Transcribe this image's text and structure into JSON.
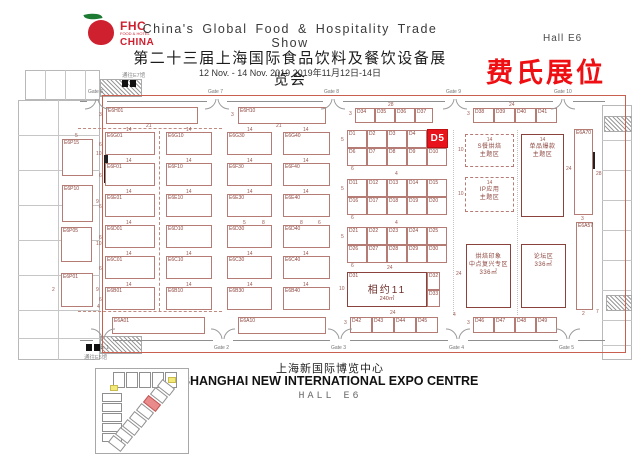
{
  "header": {
    "logo": {
      "fhc": "FHC",
      "sub": "FOOD & HOTEL",
      "china": "CHINA"
    },
    "title_en": "China's Global Food & Hospitality Trade Show",
    "hall": "Hall E6",
    "title_cn": "第二十三届上海国际食品饮料及餐饮设备展览会",
    "dates": "12 Nov. - 14 Nov. 2019   2019年11月12日-14日",
    "note": "费氏展位"
  },
  "footer": {
    "cn": "上海新国际博览中心",
    "en": "SHANGHAI NEW INTERNATIONAL EXPO CENTRE",
    "hall": "HALL E6"
  },
  "colors": {
    "booth_border": "#b57c75",
    "booth_label": "#8d463f",
    "highlight_bg": "#e8131b",
    "highlight_fg": "#ffffff",
    "hall_border": "#c9604f",
    "note_red": "#ef0e11",
    "logo_red": "#cf2030",
    "inset_highlight": "#e98b8b"
  },
  "plan": {
    "highlight_booth": {
      "id": "D5",
      "x": 427,
      "y": 129,
      "w": 21,
      "h": 19
    },
    "booths": [
      [
        "E6H01",
        106,
        107,
        92,
        17
      ],
      [
        "E6H10",
        238,
        107,
        88,
        17
      ],
      [
        "D34",
        355,
        108,
        20,
        15
      ],
      [
        "D35",
        375,
        108,
        20,
        15
      ],
      [
        "D36",
        395,
        108,
        20,
        15
      ],
      [
        "D37",
        415,
        108,
        18,
        15
      ],
      [
        "D38",
        473,
        108,
        21,
        15
      ],
      [
        "D39",
        494,
        108,
        21,
        15
      ],
      [
        "D40",
        515,
        108,
        21,
        15
      ],
      [
        "D41",
        536,
        108,
        21,
        15
      ],
      [
        "E6P15",
        62,
        139,
        31,
        37
      ],
      [
        "E6P10",
        62,
        185,
        31,
        37
      ],
      [
        "E6P05",
        61,
        227,
        31,
        35
      ],
      [
        "E6P01",
        61,
        273,
        32,
        34
      ],
      [
        "E6G01",
        105,
        132,
        50,
        23
      ],
      [
        "E6G10",
        166,
        132,
        46,
        23
      ],
      [
        "E6G30",
        227,
        132,
        45,
        23
      ],
      [
        "E6G40",
        283,
        132,
        47,
        23
      ],
      [
        "E6F01",
        105,
        163,
        50,
        23
      ],
      [
        "E6F10",
        166,
        163,
        46,
        23
      ],
      [
        "E6F30",
        227,
        163,
        45,
        23
      ],
      [
        "E6F40",
        283,
        163,
        47,
        23
      ],
      [
        "E6E01",
        105,
        194,
        50,
        23
      ],
      [
        "E6E10",
        166,
        194,
        46,
        23
      ],
      [
        "E6E30",
        227,
        194,
        45,
        23
      ],
      [
        "E6E40",
        283,
        194,
        47,
        23
      ],
      [
        "E6D01",
        105,
        225,
        50,
        23
      ],
      [
        "E6D10",
        166,
        225,
        46,
        23
      ],
      [
        "E6D30",
        227,
        225,
        45,
        23
      ],
      [
        "E6D40",
        283,
        225,
        47,
        23
      ],
      [
        "E6C01",
        105,
        256,
        50,
        23
      ],
      [
        "E6C10",
        166,
        256,
        46,
        23
      ],
      [
        "E6C30",
        227,
        256,
        45,
        23
      ],
      [
        "E6C40",
        283,
        256,
        47,
        23
      ],
      [
        "E6B01",
        105,
        287,
        50,
        23
      ],
      [
        "E6B10",
        166,
        287,
        46,
        23
      ],
      [
        "E6B30",
        227,
        287,
        45,
        23
      ],
      [
        "E6B40",
        283,
        287,
        47,
        23
      ],
      [
        "E6A01",
        112,
        317,
        93,
        17
      ],
      [
        "E6A10",
        238,
        317,
        88,
        17
      ],
      [
        "D42",
        350,
        317,
        22,
        16
      ],
      [
        "D43",
        372,
        317,
        22,
        16
      ],
      [
        "D44",
        394,
        317,
        22,
        16
      ],
      [
        "D45",
        416,
        317,
        22,
        16
      ],
      [
        "D46",
        473,
        317,
        21,
        16
      ],
      [
        "D47",
        494,
        317,
        21,
        16
      ],
      [
        "D48",
        515,
        317,
        21,
        16
      ],
      [
        "D49",
        536,
        317,
        21,
        16
      ],
      [
        "D1",
        347,
        130,
        20,
        18
      ],
      [
        "D2",
        367,
        130,
        20,
        18
      ],
      [
        "D3",
        387,
        130,
        20,
        18
      ],
      [
        "D4",
        407,
        130,
        20,
        18
      ],
      [
        "D6",
        347,
        148,
        20,
        18
      ],
      [
        "D7",
        367,
        148,
        20,
        18
      ],
      [
        "D8",
        387,
        148,
        20,
        18
      ],
      [
        "D9",
        407,
        148,
        20,
        18
      ],
      [
        "D10",
        427,
        148,
        20,
        18
      ],
      [
        "D11",
        347,
        179,
        20,
        18
      ],
      [
        "D12",
        367,
        179,
        20,
        18
      ],
      [
        "D13",
        387,
        179,
        20,
        18
      ],
      [
        "D14",
        407,
        179,
        20,
        18
      ],
      [
        "D15",
        427,
        179,
        20,
        18
      ],
      [
        "D16",
        347,
        197,
        20,
        18
      ],
      [
        "D17",
        367,
        197,
        20,
        18
      ],
      [
        "D18",
        387,
        197,
        20,
        18
      ],
      [
        "D19",
        407,
        197,
        20,
        18
      ],
      [
        "D20",
        427,
        197,
        20,
        18
      ],
      [
        "D21",
        347,
        227,
        20,
        18
      ],
      [
        "D22",
        367,
        227,
        20,
        18
      ],
      [
        "D23",
        387,
        227,
        20,
        18
      ],
      [
        "D24",
        407,
        227,
        20,
        18
      ],
      [
        "D25",
        427,
        227,
        20,
        18
      ],
      [
        "D26",
        347,
        245,
        20,
        18
      ],
      [
        "D27",
        367,
        245,
        20,
        18
      ],
      [
        "D28",
        387,
        245,
        20,
        18
      ],
      [
        "D29",
        407,
        245,
        20,
        18
      ],
      [
        "D30",
        427,
        245,
        20,
        18
      ],
      [
        "D32",
        427,
        272,
        13,
        18
      ],
      [
        "D33",
        427,
        290,
        13,
        17
      ],
      [
        "E6A70",
        574,
        129,
        19,
        86
      ],
      [
        "E6A57",
        576,
        222,
        17,
        88
      ]
    ],
    "meet_block": {
      "x": 347,
      "y": 272,
      "w": 80,
      "h": 35,
      "corner_id": "D31",
      "title": "相约11",
      "area": "240㎡"
    },
    "theme_areas": [
      {
        "style": "dashed",
        "x": 465,
        "y": 134,
        "w": 49,
        "h": 33,
        "dim_top": "14",
        "lines": [
          "S餐烘焙",
          "主题区"
        ]
      },
      {
        "style": "dashed",
        "x": 465,
        "y": 177,
        "w": 49,
        "h": 35,
        "dim_top": "14",
        "lines": [
          "IP应用",
          "主题区"
        ]
      },
      {
        "style": "solid",
        "x": 521,
        "y": 134,
        "w": 43,
        "h": 83,
        "dim_top": "14",
        "lines": [
          "单品爆款",
          "主题区"
        ]
      },
      {
        "style": "solid",
        "x": 466,
        "y": 244,
        "w": 45,
        "h": 64,
        "dim_top": "",
        "lines": [
          "烘焙印象",
          "中点复兴专区",
          "336㎡"
        ]
      },
      {
        "style": "solid",
        "x": 521,
        "y": 244,
        "w": 45,
        "h": 64,
        "dim_top": "",
        "lines": [
          "论坛区",
          "336㎡"
        ]
      }
    ],
    "gates_top": [
      [
        "Gate 6",
        97
      ],
      [
        "Gate 7",
        217
      ],
      [
        "Gate 8",
        333
      ],
      [
        "Gate 9",
        455
      ],
      [
        "Gate 10",
        563
      ]
    ],
    "gates_bottom": [
      [
        "Gate 1",
        103
      ],
      [
        "Gate 2",
        223
      ],
      [
        "Gate 3",
        340
      ],
      [
        "Gate 4",
        458
      ],
      [
        "Gate 5",
        568
      ]
    ],
    "notes": [
      [
        "通往E7馆",
        122,
        71
      ],
      [
        "通往E5馆",
        84,
        353
      ]
    ],
    "dims": [
      [
        "3",
        99,
        113
      ],
      [
        "21",
        146,
        124
      ],
      [
        "3",
        231,
        113
      ],
      [
        "21",
        276,
        124
      ],
      [
        "3",
        349,
        112
      ],
      [
        "28",
        388,
        103
      ],
      [
        "3",
        467,
        112
      ],
      [
        "24",
        509,
        103
      ],
      [
        "5",
        75,
        134
      ],
      [
        "10",
        96,
        152
      ],
      [
        "9",
        96,
        200
      ],
      [
        "10",
        96,
        242
      ],
      [
        "9",
        96,
        288
      ],
      [
        "2",
        52,
        288
      ],
      [
        "4",
        97,
        305
      ],
      [
        "6",
        99,
        143
      ],
      [
        "6",
        99,
        174
      ],
      [
        "6",
        99,
        205
      ],
      [
        "6",
        99,
        236
      ],
      [
        "6",
        99,
        267
      ],
      [
        "6",
        99,
        298
      ],
      [
        "14",
        126,
        128
      ],
      [
        "14",
        186,
        128
      ],
      [
        "14",
        247,
        128
      ],
      [
        "14",
        303,
        128
      ],
      [
        "14",
        126,
        159
      ],
      [
        "14",
        186,
        159
      ],
      [
        "14",
        247,
        159
      ],
      [
        "14",
        303,
        159
      ],
      [
        "14",
        126,
        190
      ],
      [
        "14",
        186,
        190
      ],
      [
        "14",
        247,
        190
      ],
      [
        "14",
        303,
        190
      ],
      [
        "14",
        126,
        221
      ],
      [
        "5",
        243,
        221
      ],
      [
        "8",
        262,
        221
      ],
      [
        "8",
        300,
        221
      ],
      [
        "6",
        318,
        221
      ],
      [
        "14",
        126,
        252
      ],
      [
        "14",
        186,
        252
      ],
      [
        "14",
        247,
        252
      ],
      [
        "14",
        303,
        252
      ],
      [
        "14",
        126,
        283
      ],
      [
        "14",
        186,
        283
      ],
      [
        "14",
        247,
        283
      ],
      [
        "14",
        303,
        283
      ],
      [
        "5",
        341,
        138
      ],
      [
        "6",
        351,
        167
      ],
      [
        "4",
        395,
        172
      ],
      [
        "5",
        341,
        187
      ],
      [
        "6",
        351,
        216
      ],
      [
        "4",
        395,
        221
      ],
      [
        "5",
        341,
        235
      ],
      [
        "6",
        351,
        264
      ],
      [
        "24",
        387,
        266
      ],
      [
        "10",
        339,
        287
      ],
      [
        "10",
        458,
        148
      ],
      [
        "10",
        458,
        192
      ],
      [
        "24",
        566,
        167
      ],
      [
        "28",
        596,
        172
      ],
      [
        "24",
        456,
        272
      ],
      [
        "3",
        581,
        217
      ],
      [
        "2",
        582,
        312
      ],
      [
        "7",
        596,
        310
      ],
      [
        "24",
        390,
        311
      ],
      [
        "3",
        344,
        321
      ],
      [
        "3",
        467,
        321
      ],
      [
        "4",
        453,
        313
      ]
    ]
  },
  "inset": {
    "top_cells": 5,
    "left_cells": 5,
    "diag_cells": 8,
    "diag_highlight_index": 2
  }
}
